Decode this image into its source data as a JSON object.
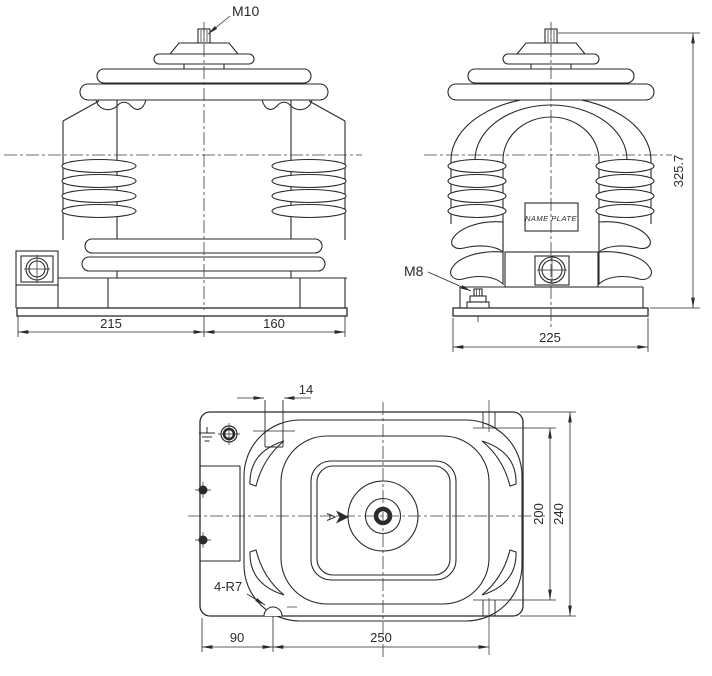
{
  "drawing": {
    "type": "engineering-dimension-drawing",
    "colors": {
      "line": "#2a2a2a",
      "background": "#ffffff"
    },
    "front_view": {
      "top_terminal_label": "M10",
      "dim_base_left": "215",
      "dim_base_right": "160"
    },
    "side_view": {
      "ground_bolt_label": "M8",
      "nameplate_text": "NAME PLATE",
      "dim_total_height": "325.7",
      "dim_base_width": "225"
    },
    "plan_view": {
      "dim_slot_width": "14",
      "dim_slot_span_vertical": "200",
      "dim_plate_height": "240",
      "dim_edge_to_notch": "90",
      "dim_notch_to_slot": "250",
      "corner_radius_note": "4-R7",
      "view_direction_label": "A"
    }
  }
}
